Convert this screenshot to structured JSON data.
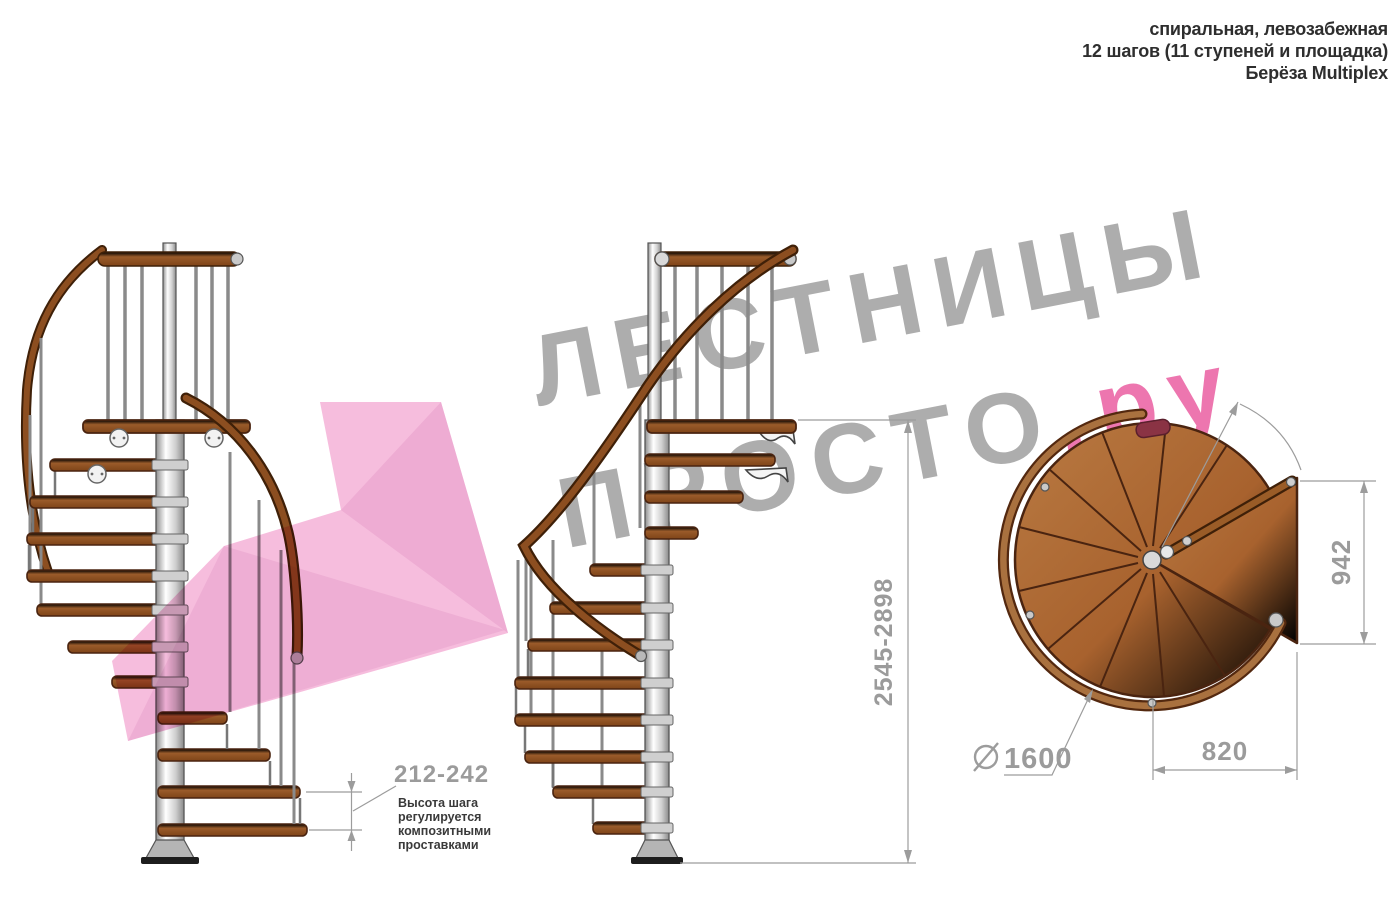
{
  "header": {
    "lines": [
      "спиральная, левозабежная",
      "12 шагов (11 ступеней и площадка)",
      "Берёза Multiplex"
    ]
  },
  "watermark": {
    "line1": "ЛЕСТНИЦЫ",
    "line2_gray": "ПРОСТО",
    "line2_pink": ".ру"
  },
  "dimensions": {
    "step_height": {
      "value": "212-242",
      "note_lines": [
        "Высота шага",
        "регулируется",
        "композитными",
        "проставками"
      ]
    },
    "total_height": {
      "value": "2545-2898"
    },
    "landing_side": {
      "value": "942"
    },
    "landing_width": {
      "value": "820"
    },
    "diameter": {
      "symbol": "⌀",
      "value": "1600"
    }
  },
  "colors": {
    "wood": "#9a5b2a",
    "wood_dark_edge": "#4a2410",
    "handrail": "#7b431c",
    "steel": "#d8d8d8",
    "dimension_gray": "#9b9b9b",
    "note_text": "#3a3a3a",
    "watermark_gray": "#969696",
    "watermark_pink": "#e9589e",
    "arrow_pink": "#f3aad4"
  }
}
